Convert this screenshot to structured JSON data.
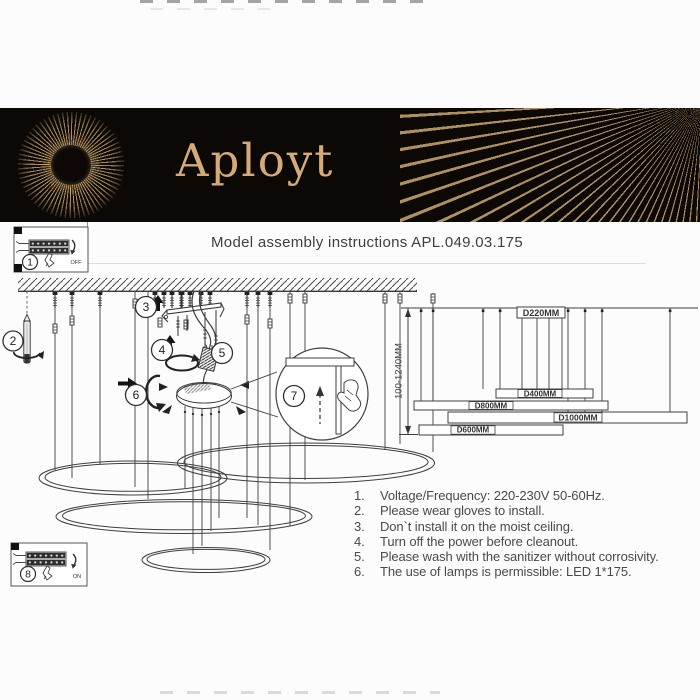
{
  "brand": {
    "name": "Aployt"
  },
  "header": {
    "title": "Model assembly instructions APL.049.03.175"
  },
  "callouts": {
    "n1": "1",
    "n2": "2",
    "n3": "3",
    "n4": "4",
    "n5": "5",
    "n6": "6",
    "n7": "7",
    "n8": "8"
  },
  "switch_labels": {
    "off": "OFF",
    "on": "ON"
  },
  "dimensions": {
    "height_range": "100-1240MM",
    "ring_labels": [
      "D220MM",
      "D400MM",
      "D800MM",
      "D1000MM",
      "D600MM"
    ]
  },
  "instructions": {
    "items": [
      {
        "num": "1.",
        "text": "Voltage/Frequency: 220-230V 50-60Hz."
      },
      {
        "num": "2.",
        "text": "Please wear gloves to install."
      },
      {
        "num": "3.",
        "text": "Don`t install it on the moist ceiling."
      },
      {
        "num": "4.",
        "text": "Turn off the power before cleanout."
      },
      {
        "num": "5.",
        "text": "Please wash with the sanitizer without corrosivity."
      },
      {
        "num": "6.",
        "text": "The use of lamps is permissible: LED 1*175."
      }
    ]
  },
  "colors": {
    "banner_bg": "#0b0806",
    "brand_gold": "#d4aa78",
    "line": "#3f3f3f",
    "text": "#4a4a4a"
  }
}
